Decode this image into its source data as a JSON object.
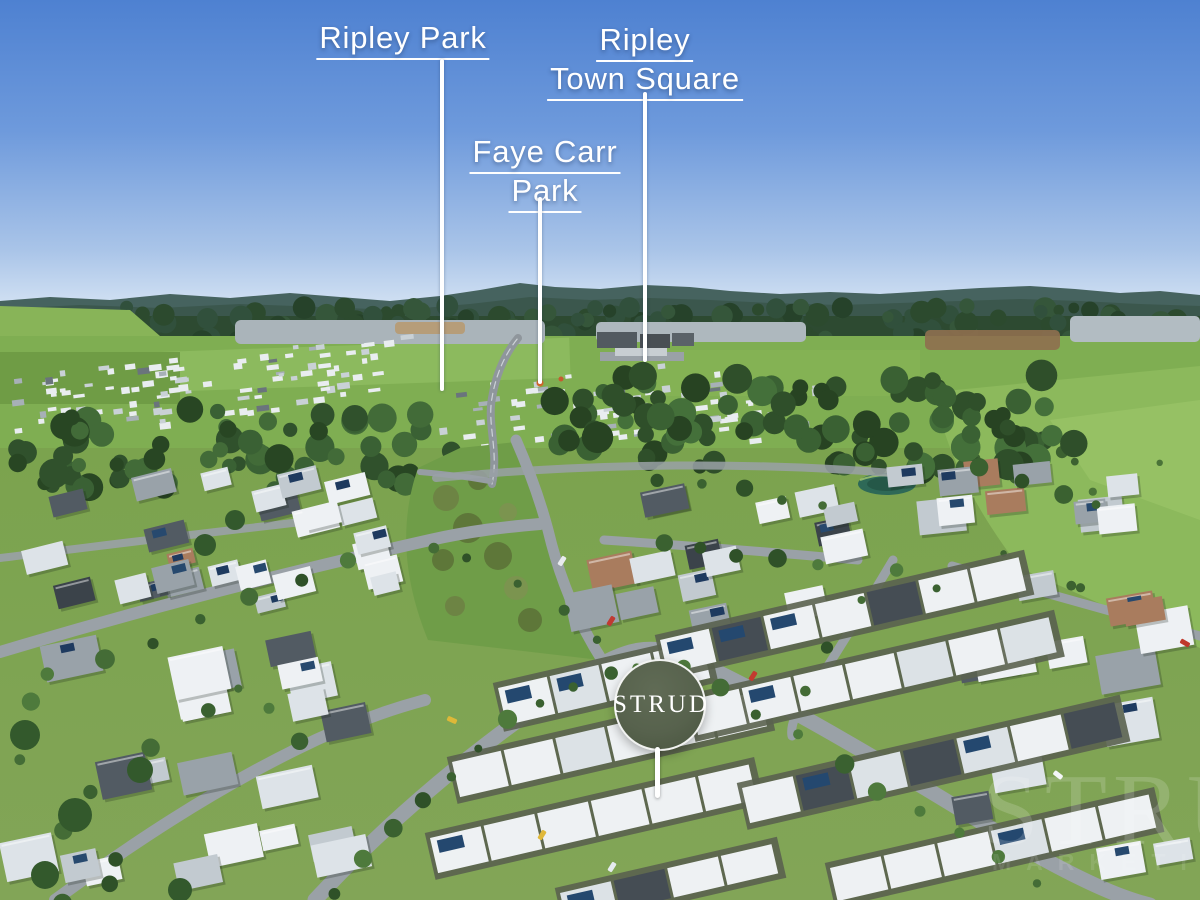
{
  "scene": {
    "description": "Aerial drone photograph of a master-planned residential estate at Ripley on a clear sunny day, with bushland, green fields and distant mountain ranges behind the suburbs"
  },
  "callouts": [
    {
      "id": "ripley-park",
      "lines": [
        "Ripley Park"
      ]
    },
    {
      "id": "faye-carr-park",
      "lines": [
        "Faye Carr",
        "Park"
      ]
    },
    {
      "id": "ripley-town-square",
      "lines": [
        "Ripley",
        "Town Square"
      ]
    }
  ],
  "badge": {
    "text": "STRUD"
  },
  "watermark": {
    "text": "STRUD",
    "subtext": "MARKETING"
  },
  "colors": {
    "callout_text": "#FFFFFF",
    "leader_line": "#FFFFFF",
    "badge_background": "#57624D",
    "badge_text": "#FFFFFF",
    "sky_top": "#4E81D1",
    "sky_horizon": "#D6E4F4",
    "field_green": "#7FAE52",
    "forest_green": "#31502C",
    "roof_white": "#EEF1F4",
    "road_grey": "#9AA1A7",
    "solar_panel_blue": "#24486F",
    "pond_teal": "#2E6957"
  }
}
